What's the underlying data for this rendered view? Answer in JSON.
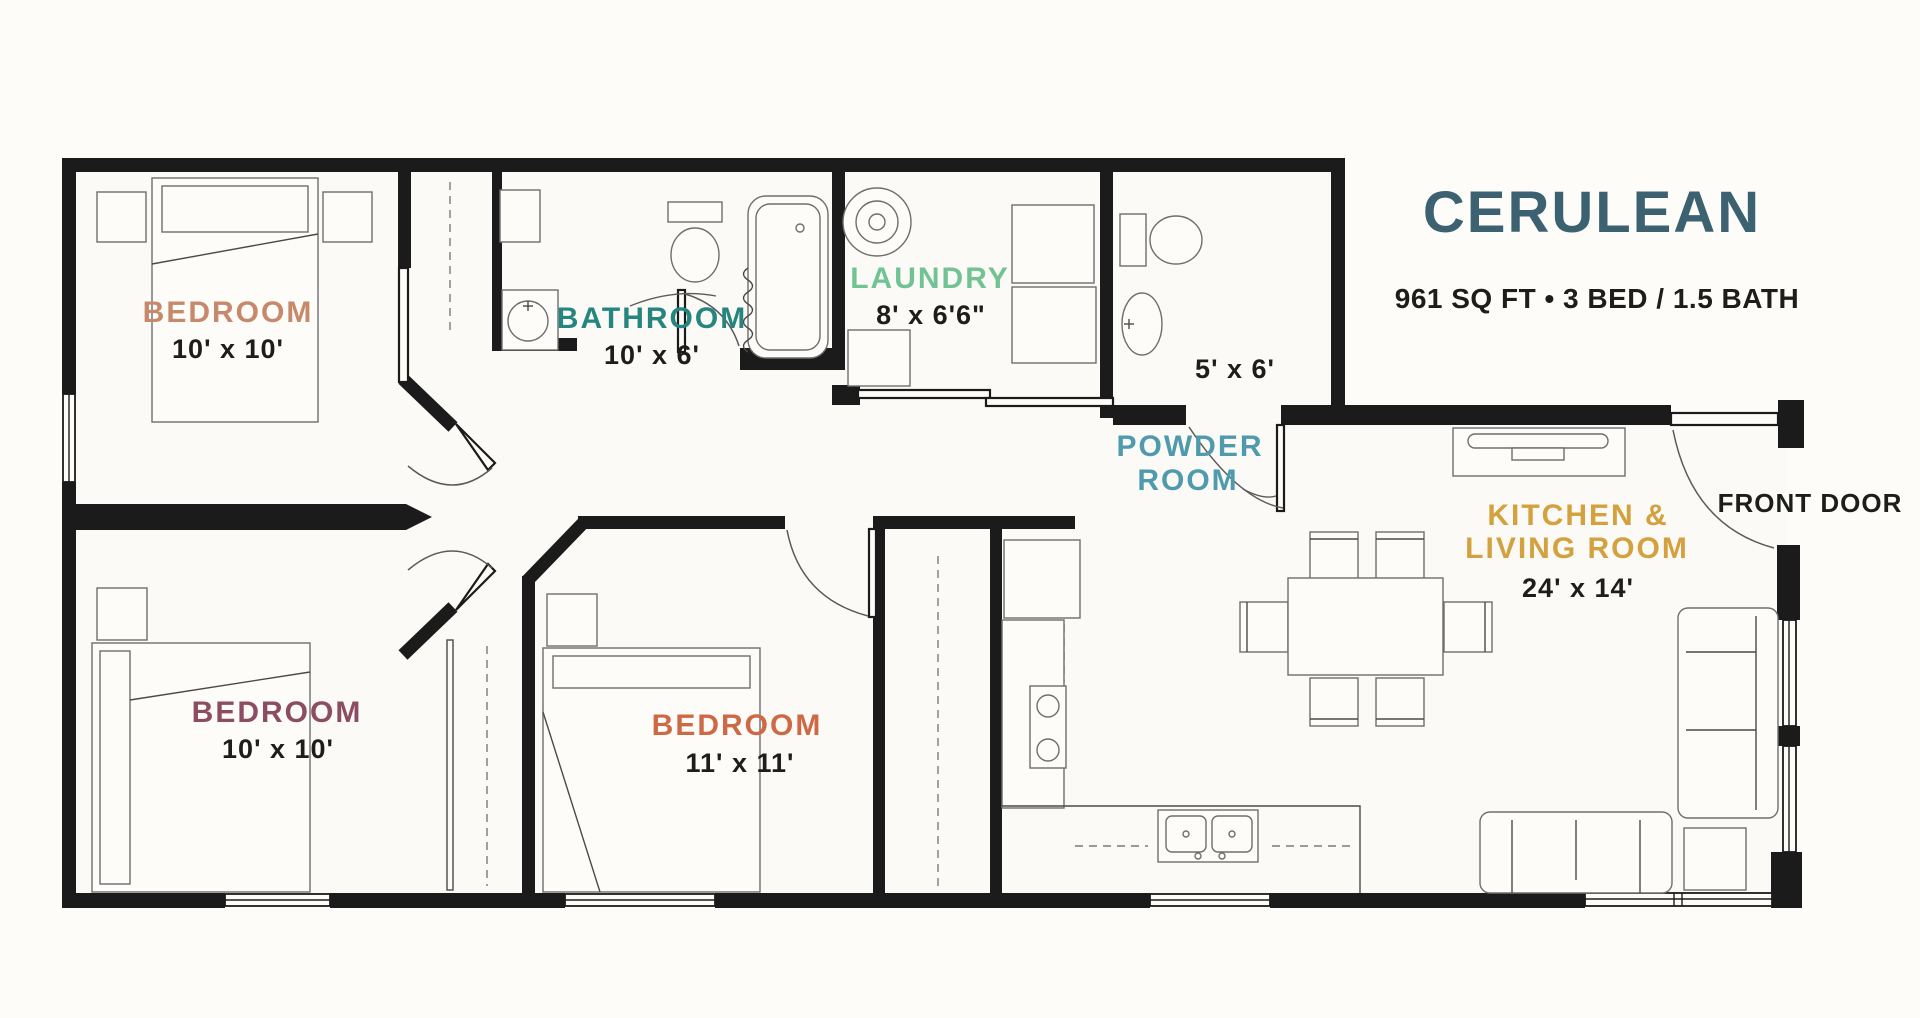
{
  "title": "CERULEAN",
  "summary": "961 SQ FT  •  3 BED / 1.5 BATH",
  "title_color": "#3c6170",
  "front_door_label": "FRONT DOOR",
  "rooms": [
    {
      "name": "BEDROOM",
      "dims": "10' x 10'",
      "color": "#c6896b"
    },
    {
      "name": "BATHROOM",
      "dims": "10' x 6'",
      "color": "#27857f"
    },
    {
      "name": "LAUNDRY",
      "dims": "8' x 6'6\"",
      "color": "#72c393"
    },
    {
      "name_line1": "POWDER",
      "name_line2": "ROOM",
      "dims": "5' x 6'",
      "color": "#4f9aac"
    },
    {
      "name": "BEDROOM",
      "dims": "10' x 10'",
      "color": "#8c4d63"
    },
    {
      "name": "BEDROOM",
      "dims": "11' x 11'",
      "color": "#cd6a45"
    },
    {
      "name_line1": "KITCHEN &",
      "name_line2": "LIVING ROOM",
      "dims": "24' x 14'",
      "color": "#d3a13e"
    }
  ]
}
